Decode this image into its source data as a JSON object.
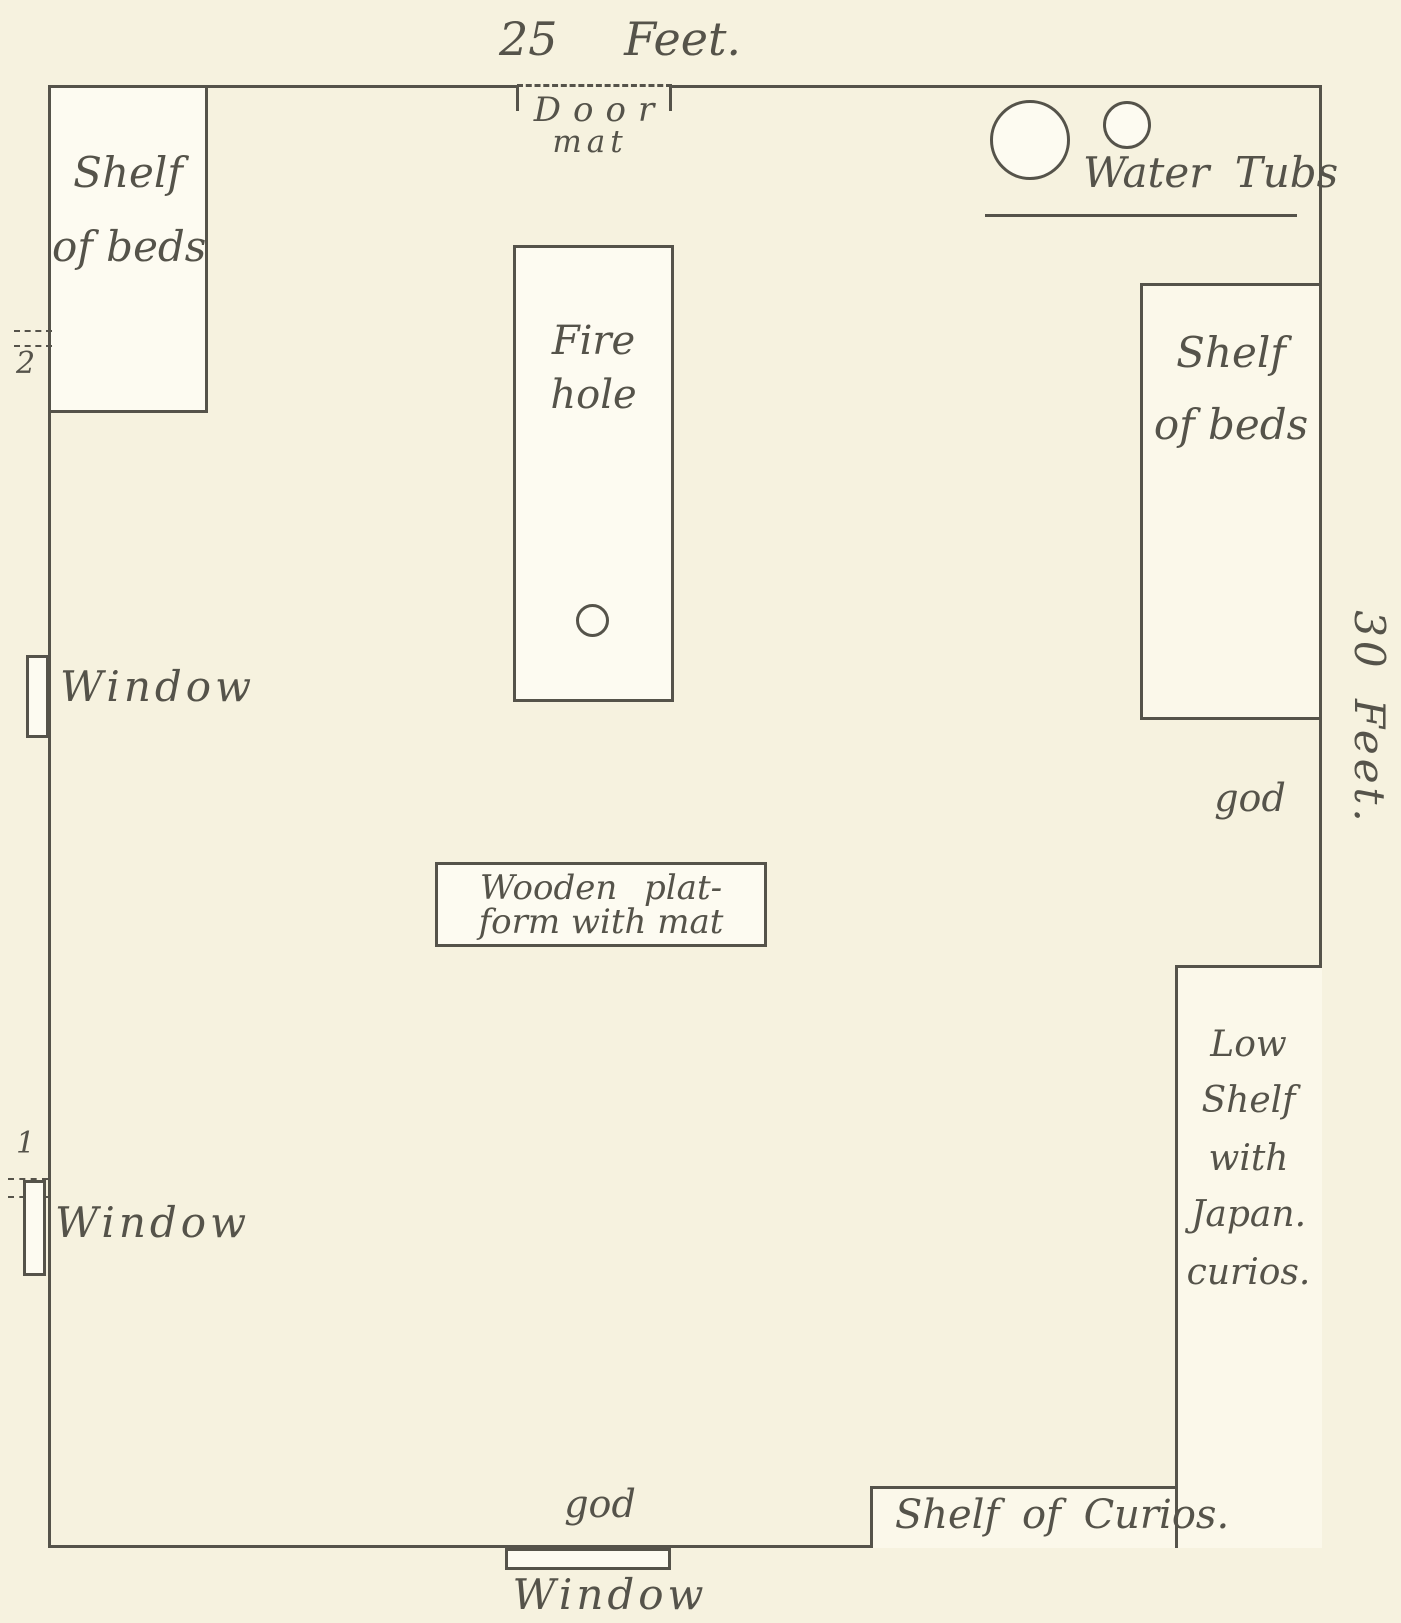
{
  "palette": {
    "paper": "#f6f2df",
    "ink": "#55534a",
    "box_fill": "#fdfbf1"
  },
  "plan": {
    "width_label": "25 Feet.",
    "height_label": "30 Feet.",
    "door": {
      "line1": "Door",
      "line2": "mat"
    },
    "water_tubs": {
      "label": "Water Tubs"
    },
    "left_shelf": {
      "line1": "Shelf",
      "line2": "of beds"
    },
    "right_shelf": {
      "line1": "Shelf",
      "line2": "of beds"
    },
    "fire_hole": {
      "line1": "Fire",
      "line2": "hole"
    },
    "platform": {
      "line1": "Wooden plat-",
      "line2": "form with mat"
    },
    "god_right": "god",
    "god_bottom": "god",
    "window_upper_left": "Window",
    "window_lower_left": "Window",
    "window_bottom": "Window",
    "marker_upper": "2",
    "marker_lower": "1",
    "low_shelf": {
      "lines": [
        "Low",
        "Shelf",
        "with",
        "Japan.",
        "curios."
      ]
    },
    "curios_shelf": {
      "label": "Shelf of Curios."
    }
  }
}
